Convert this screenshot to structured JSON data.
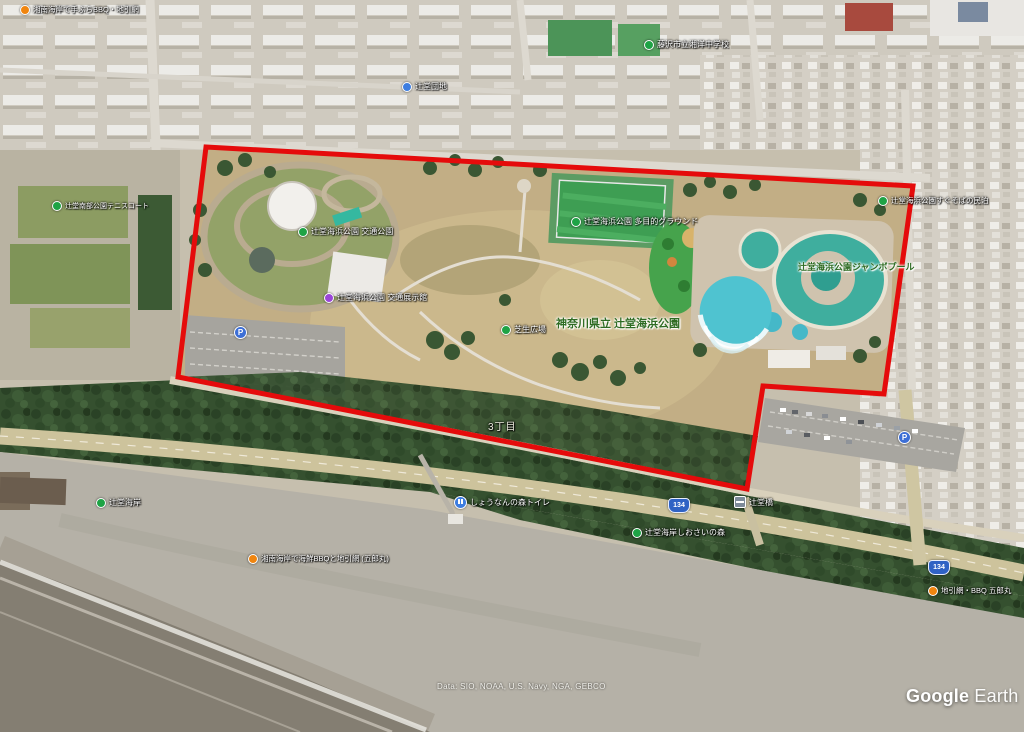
{
  "app": {
    "watermark_google": "Google",
    "watermark_earth": " Earth",
    "attribution": "Data: SIO, NOAA, U.S. Navy, NGA, GEBCO"
  },
  "boundary": {
    "color": "#e50b0b",
    "points": "206,147 913,186 884,394 763,386 747,489 178,377"
  },
  "route_shield": {
    "label": "134"
  },
  "parking_icon": {
    "label": "P"
  },
  "labels": [
    {
      "id": "bbq-topleft",
      "text": "湘南海岸で手ぶらBBQ・地引網"
    },
    {
      "id": "tennis",
      "text": "辻堂南部公園テニスコート"
    },
    {
      "id": "danchi",
      "text": "辻堂団地"
    },
    {
      "id": "school",
      "text": "藤沢市立湘洋中学校"
    },
    {
      "id": "minpaku",
      "text": "辻堂海浜公園すぐそばの民泊"
    },
    {
      "id": "traffic-park",
      "text": "辻堂海浜公園 交通公園"
    },
    {
      "id": "museum",
      "text": "辻堂海浜公園 交通展示館"
    },
    {
      "id": "lawn",
      "text": "芝生広場"
    },
    {
      "id": "park-main",
      "text": "神奈川県立 辻堂海浜公園"
    },
    {
      "id": "ground",
      "text": "辻堂海浜公園 多目的グラウンド"
    },
    {
      "id": "pool",
      "text": "辻堂海浜公園ジャンボプール"
    },
    {
      "id": "district",
      "text": "3丁目"
    },
    {
      "id": "coast",
      "text": "辻堂海岸"
    },
    {
      "id": "toilet",
      "text": "しょうなんの森トイレ"
    },
    {
      "id": "bridge",
      "text": "辻堂橋"
    },
    {
      "id": "shiosai",
      "text": "辻堂海岸しおさいの森"
    },
    {
      "id": "bbq-beach",
      "text": "湘南海岸で海鮮BBQと地引網 (五郎丸)"
    },
    {
      "id": "jibiki",
      "text": "地引網・BBQ 五郎丸"
    }
  ]
}
